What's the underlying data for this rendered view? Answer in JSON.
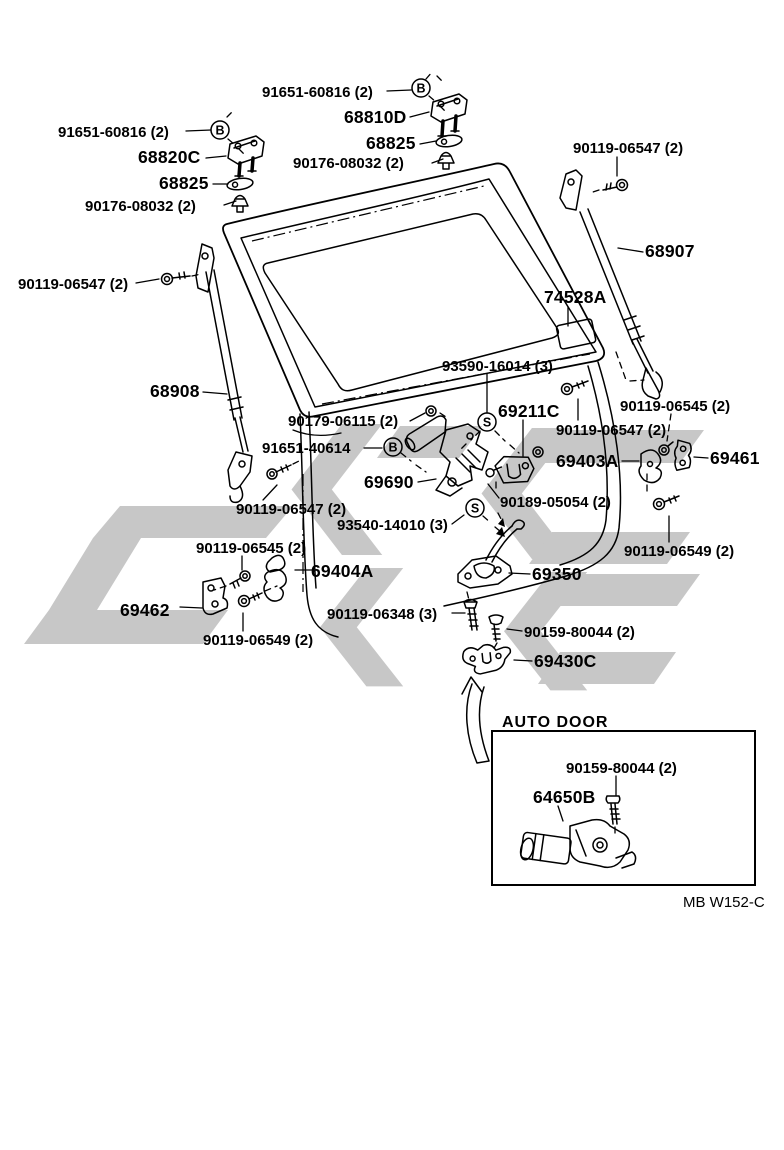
{
  "diagram_type": "exploded-parts-diagram",
  "subject": "back door lock and hinge",
  "colors": {
    "background": "#ffffff",
    "line": "#000000",
    "watermark": "#c7c7c7"
  },
  "labels": {
    "b_bolt_rh": "91651-60816 (2)",
    "hinge_rh": "68810D",
    "washer_rh": "68825",
    "grommet_rh": "90176-08032 (2)",
    "b_bolt_lh": "91651-60816 (2)",
    "hinge_lh": "68820C",
    "washer_lh": "68825",
    "grommet_lh": "90176-08032 (2)",
    "screw_stay_rh": "90119-06547 (2)",
    "stay_rh": "68907",
    "label_plate": "74528A",
    "screw_stay_lh": "90119-06547 (2)",
    "stay_lh": "68908",
    "screw_lock_s": "93590-16014 (3)",
    "grommet_lock": "90179-06115 (2)",
    "striker_upper": "69211C",
    "b_bolt_lock": "91651-40614",
    "lock_assy": "69690",
    "screw_striker_upper": "90189-05054 (2)",
    "screw_latch_s": "93540-14010 (3)",
    "screw_stay_lh2": "90119-06547 (2)",
    "screw_hinge_rh": "90119-06545 (2)",
    "screw_stay_rh2": "90119-06547 (2)",
    "clamp_rh": "69403A",
    "hinge_lower_rh": "69461",
    "bolt_hinge_rh": "90119-06549 (2)",
    "screw_hinge_lh": "90119-06545 (2)",
    "bellcrank": "69404A",
    "hinge_lower_lh": "69462",
    "bolt_hinge_lh": "90119-06549 (2)",
    "bolt_latch": "90119-06348 (3)",
    "latch_assy": "69350",
    "screw_striker_lower": "90159-80044 (2)",
    "striker_lower": "69430C"
  },
  "markers": {
    "b": "B",
    "s": "S"
  },
  "inset": {
    "title": "AUTO DOOR",
    "screw_motor": "90159-80044 (2)",
    "motor": "64650B"
  },
  "footer": {
    "code": "MB W152-C"
  }
}
